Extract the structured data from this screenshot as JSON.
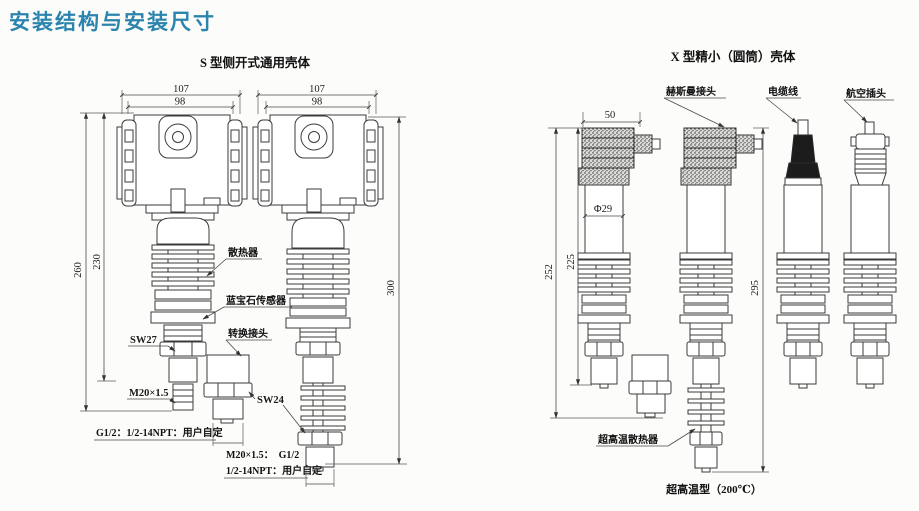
{
  "page": {
    "title": "安装结构与安装尺寸"
  },
  "s_section": {
    "title": "S 型侧开式通用壳体",
    "dims": {
      "head_width_outer": "107",
      "head_width_inner": "98",
      "height_outer": "260",
      "height_inner": "230",
      "height_long": "300",
      "hex_top": "SW27",
      "hex_adapter": "SW24",
      "thread": "M20×1.5"
    },
    "labels": {
      "heatsink": "散热器",
      "sapphire_sensor": "蓝宝石传感器",
      "conversion_adapter": "转换接头"
    },
    "notes": {
      "thread_options_left": "G1/2：1/2-14NPT：用户自定",
      "thread_options_right_line1": "M20×1.5：　G1/2",
      "thread_options_right_line2": "1/2-14NPT：用户自定"
    }
  },
  "x_section": {
    "title": "X 型精小（圆筒）壳体",
    "dims": {
      "connector_width": "50",
      "body_diameter": "Φ29",
      "height_outer": "252",
      "height_inner": "225",
      "height_high_temp": "295"
    },
    "labels": {
      "hirschmann_connector": "赫斯曼接头",
      "cable": "电缆线",
      "aviation_plug": "航空插头",
      "high_temp_heatsink": "超高温散热器"
    },
    "caption_high_temp": "超高温型（200℃）"
  }
}
